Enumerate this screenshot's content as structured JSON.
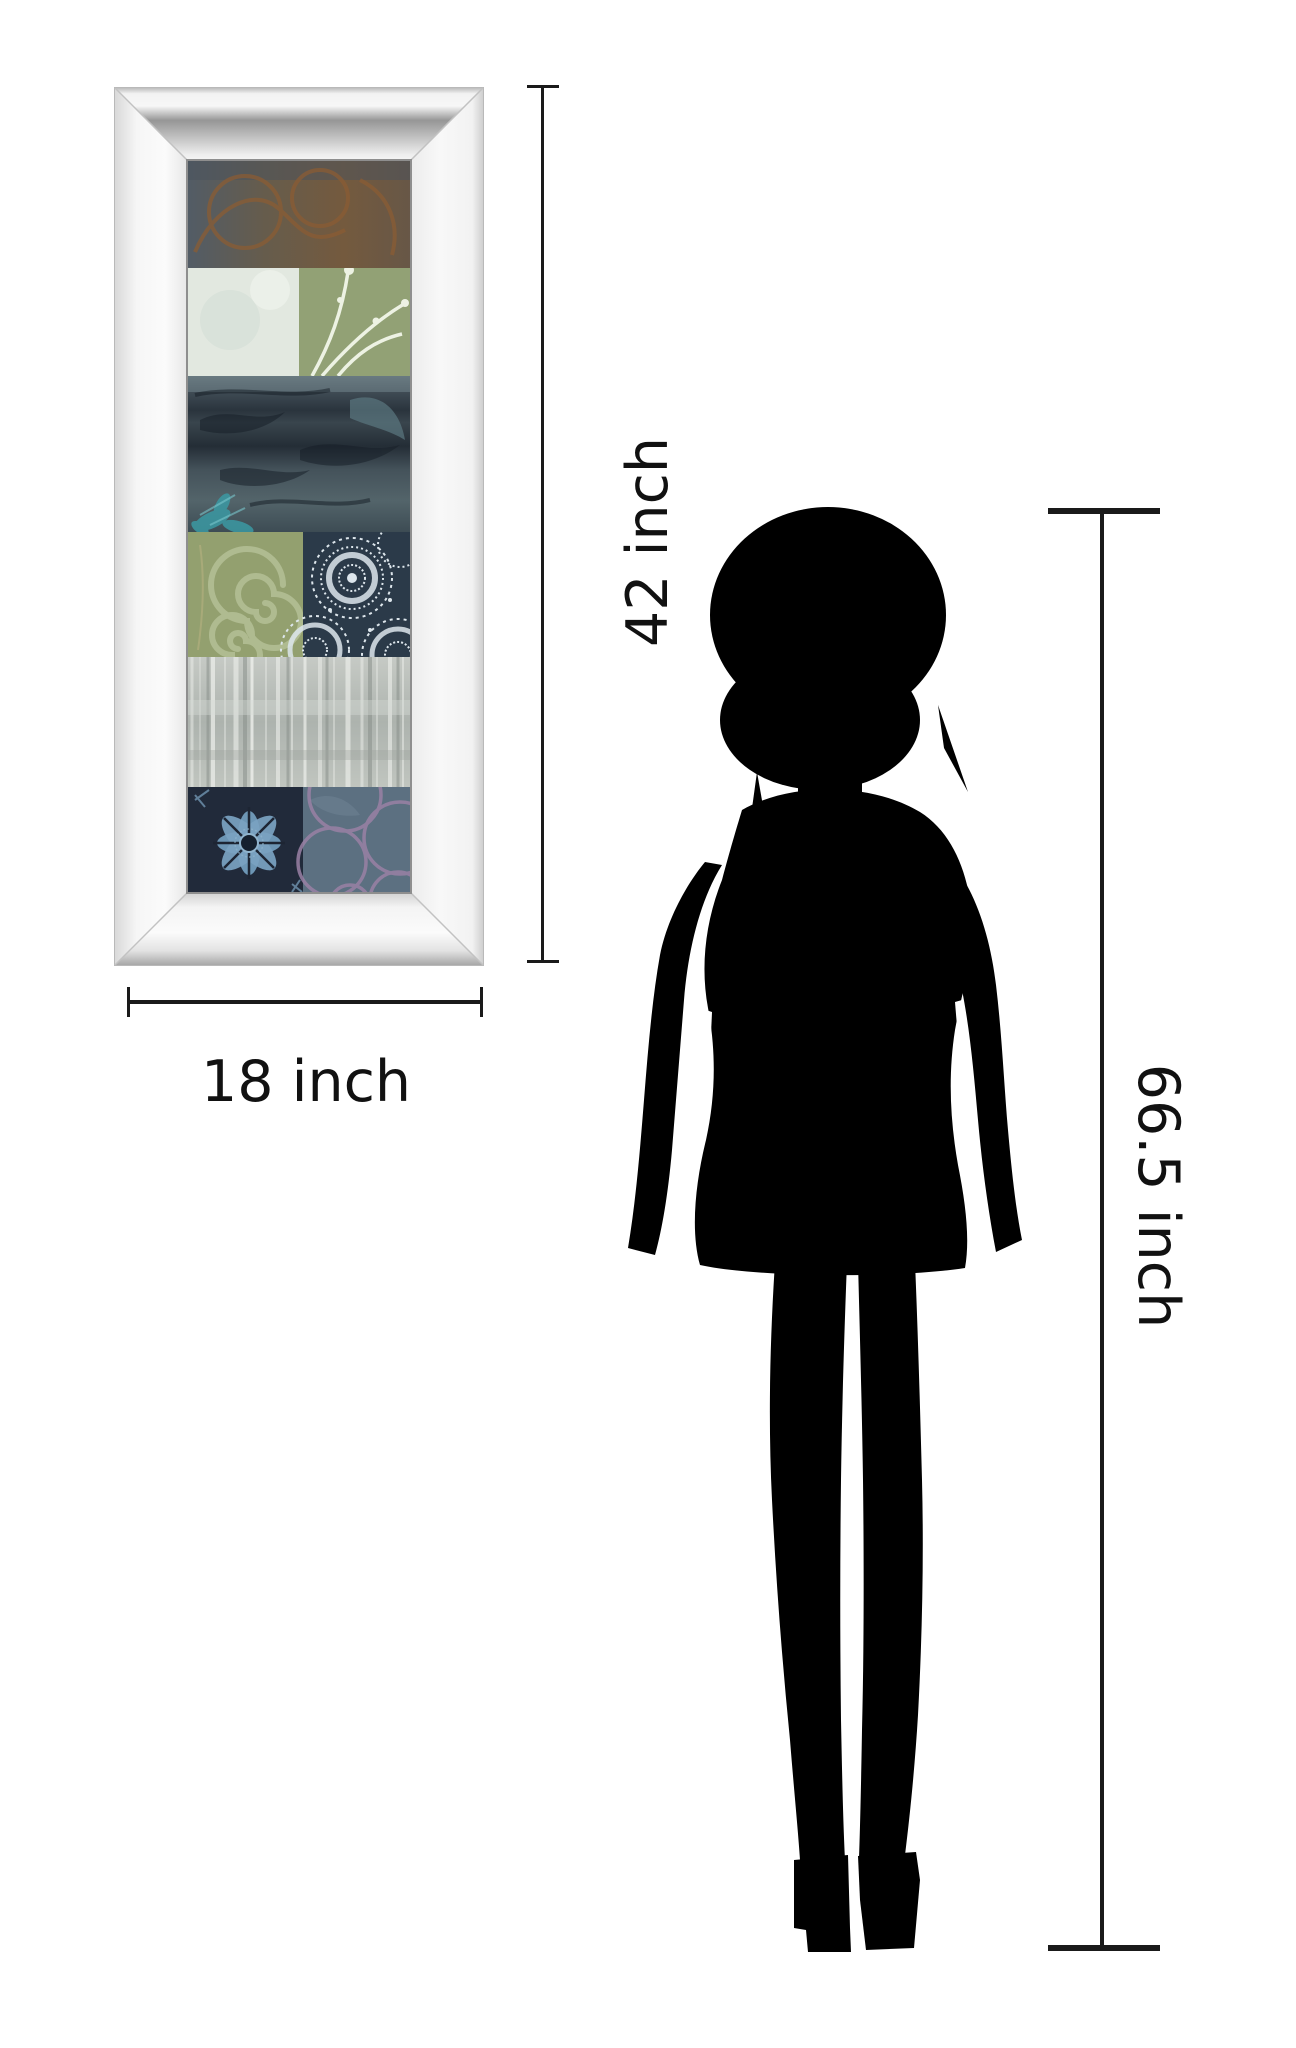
{
  "title": "Framed wall art size comparison diagram",
  "dimensions": {
    "artwork_height": {
      "label": "42 inch"
    },
    "artwork_width": {
      "label": "18 inch"
    },
    "person_height": {
      "label": "66.5 inch"
    },
    "line_color": "#1a1a1a",
    "label_color": "#111111"
  },
  "artwork": {
    "frame_style": "beveled-mirror-frame",
    "frame_colors": {
      "face": "#f6f6f6",
      "bevel_dark": "#8f8f8f",
      "bevel_light": "#e8e8e8",
      "outline": "#b9b9b9"
    },
    "panel_sections": [
      {
        "name": "rust-swirls-on-slate",
        "colors": [
          "#525c66",
          "#745a3e",
          "#8a5c34"
        ]
      },
      {
        "name": "pale-aqua-and-green-botanical",
        "colors": [
          "#e2e8e0",
          "#92a175",
          "#edf2e3"
        ]
      },
      {
        "name": "dark-teal-leaf-shadows",
        "colors": [
          "#39444d",
          "#242d36",
          "#3b99a3"
        ]
      },
      {
        "name": "green-spirals-and-navy-lace-medallions",
        "colors": [
          "#93a06f",
          "#b7c299",
          "#2b3a49",
          "#dde6ec"
        ]
      },
      {
        "name": "silver-birch-texture",
        "colors": [
          "#b3b9b4",
          "#eef0ec"
        ]
      },
      {
        "name": "navy-batik-flower-and-lilac-circles",
        "colors": [
          "#212a3a",
          "#7ba3c2",
          "#5c7081",
          "#9a81a5"
        ]
      }
    ]
  },
  "figure": {
    "name": "standing-woman-silhouette",
    "color": "#000000"
  }
}
